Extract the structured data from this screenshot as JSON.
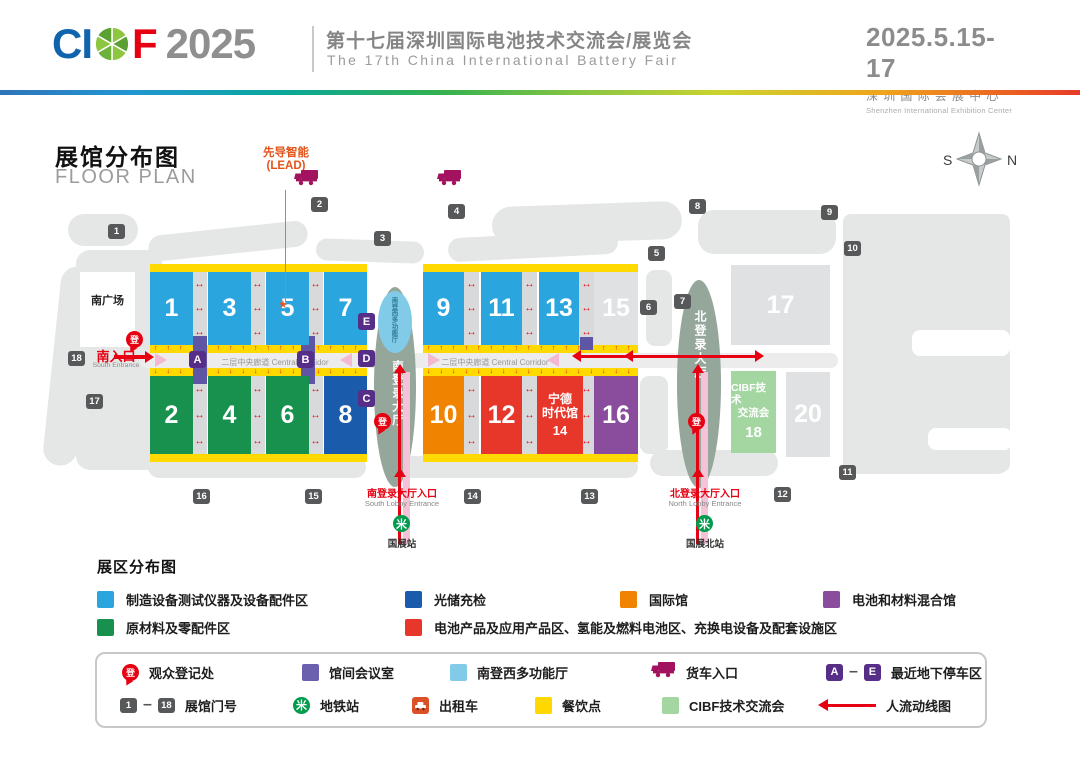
{
  "header": {
    "logo_ci": "CI",
    "logo_f": "F",
    "logo_year": "2025",
    "title_cn": "第十七届深圳国际电池技术交流会/展览会",
    "title_en": "The 17th China International Battery Fair",
    "dates": "2025.5.15-17",
    "venue_cn": "深圳国际会展中心",
    "venue_en": "Shenzhen International Exhibition Center"
  },
  "plan": {
    "title_cn": "展馆分布图",
    "title_en": "FLOOR PLAN",
    "lead_line1": "先导智能",
    "lead_line2": "(LEAD)",
    "compass_s": "S",
    "compass_n": "N",
    "south_plaza": "南广场",
    "south_entrance_cn": "南入口",
    "south_entrance_en": "South Entrance",
    "corridor_label": "二层中央廊道 Central Corridor",
    "south_lobby": "南登录大厅",
    "north_lobby": "北登录大厅",
    "multifunction_hall": "南登西多功能厅",
    "south_lobby_entrance_cn": "南登录大厅入口",
    "south_lobby_entrance_en": "South Lobby Entrance",
    "north_lobby_entrance_cn": "北登录大厅入口",
    "north_lobby_entrance_en": "North Lobby Entrance",
    "metro_station_south": "国展站",
    "metro_station_north": "国展北站",
    "halls": [
      {
        "n": "1",
        "x": 150,
        "y": 272,
        "w": 43,
        "h": 73,
        "c": "blue"
      },
      {
        "n": "3",
        "x": 208,
        "y": 272,
        "w": 43,
        "h": 73,
        "c": "blue"
      },
      {
        "n": "5",
        "x": 266,
        "y": 272,
        "w": 43,
        "h": 73,
        "c": "blue"
      },
      {
        "n": "7",
        "x": 324,
        "y": 272,
        "w": 43,
        "h": 73,
        "c": "blue"
      },
      {
        "n": "9",
        "x": 423,
        "y": 272,
        "w": 41,
        "h": 73,
        "c": "blue"
      },
      {
        "n": "11",
        "x": 481,
        "y": 272,
        "w": 41,
        "h": 73,
        "c": "blue"
      },
      {
        "n": "13",
        "x": 539,
        "y": 272,
        "w": 40,
        "h": 73,
        "c": "blue"
      },
      {
        "n": "15",
        "x": 594,
        "y": 272,
        "w": 44,
        "h": 73,
        "c": "gray"
      },
      {
        "n": "2",
        "x": 150,
        "y": 376,
        "w": 43,
        "h": 78,
        "c": "green"
      },
      {
        "n": "4",
        "x": 208,
        "y": 376,
        "w": 43,
        "h": 78,
        "c": "green"
      },
      {
        "n": "6",
        "x": 266,
        "y": 376,
        "w": 43,
        "h": 78,
        "c": "green"
      },
      {
        "n": "8",
        "x": 324,
        "y": 376,
        "w": 43,
        "h": 78,
        "c": "navy"
      },
      {
        "n": "10",
        "x": 423,
        "y": 376,
        "w": 41,
        "h": 78,
        "c": "orange"
      },
      {
        "n": "12",
        "x": 481,
        "y": 376,
        "w": 41,
        "h": 78,
        "c": "red"
      },
      {
        "n": "14",
        "lines": [
          "宁德",
          "时代馆"
        ],
        "x": 537,
        "y": 376,
        "w": 46,
        "h": 78,
        "c": "red"
      },
      {
        "n": "16",
        "x": 594,
        "y": 376,
        "w": 44,
        "h": 78,
        "c": "purple"
      },
      {
        "n": "17",
        "x": 731,
        "y": 265,
        "w": 99,
        "h": 80,
        "c": "gray"
      },
      {
        "n": "18",
        "lines": [
          "CIBF技术",
          "交流会"
        ],
        "x": 731,
        "y": 371,
        "w": 45,
        "h": 82,
        "c": "lightgreen"
      },
      {
        "n": "20",
        "x": 786,
        "y": 372,
        "w": 44,
        "h": 85,
        "c": "gray"
      }
    ],
    "gates": [
      {
        "n": "1",
        "x": 108,
        "y": 224
      },
      {
        "n": "2",
        "x": 311,
        "y": 197
      },
      {
        "n": "3",
        "x": 374,
        "y": 231
      },
      {
        "n": "4",
        "x": 448,
        "y": 204
      },
      {
        "n": "5",
        "x": 648,
        "y": 246
      },
      {
        "n": "6",
        "x": 640,
        "y": 300
      },
      {
        "n": "7",
        "x": 674,
        "y": 294
      },
      {
        "n": "8",
        "x": 689,
        "y": 199
      },
      {
        "n": "9",
        "x": 821,
        "y": 205
      },
      {
        "n": "10",
        "x": 844,
        "y": 241
      },
      {
        "n": "11",
        "x": 839,
        "y": 465
      },
      {
        "n": "12",
        "x": 774,
        "y": 487
      },
      {
        "n": "13",
        "x": 581,
        "y": 489
      },
      {
        "n": "14",
        "x": 464,
        "y": 489
      },
      {
        "n": "15",
        "x": 305,
        "y": 489
      },
      {
        "n": "16",
        "x": 193,
        "y": 489
      },
      {
        "n": "17",
        "x": 86,
        "y": 394
      },
      {
        "n": "18",
        "x": 68,
        "y": 351
      }
    ],
    "parking_badges": [
      {
        "n": "A",
        "x": 189,
        "y": 351
      },
      {
        "n": "B",
        "x": 297,
        "y": 351
      },
      {
        "n": "C",
        "x": 358,
        "y": 390
      },
      {
        "n": "D",
        "x": 358,
        "y": 350
      },
      {
        "n": "E",
        "x": 358,
        "y": 313
      }
    ],
    "registration_label": "登",
    "registration_pins": [
      {
        "x": 126,
        "y": 331
      },
      {
        "x": 374,
        "y": 413
      },
      {
        "x": 688,
        "y": 413
      }
    ],
    "truck_positions": [
      {
        "x": 293,
        "y": 169
      },
      {
        "x": 436,
        "y": 169
      }
    ]
  },
  "zones_legend": {
    "title": "展区分布图",
    "items": [
      {
        "color": "#2aa5dd",
        "label": "制造设备测试仪器及设备配件区",
        "x": 97,
        "y": 590
      },
      {
        "color": "#1a5cab",
        "label": "光储充检",
        "x": 405,
        "y": 590
      },
      {
        "color": "#f08300",
        "label": "国际馆",
        "x": 620,
        "y": 590
      },
      {
        "color": "#8a4d9e",
        "label": "电池和材料混合馆",
        "x": 823,
        "y": 590
      },
      {
        "color": "#17914d",
        "label": "原材料及零配件区",
        "x": 97,
        "y": 618
      },
      {
        "color": "#e7372a",
        "label": "电池产品及应用产品区、氢能及燃料电池区、充换电设备及配套设施区",
        "x": 405,
        "y": 618
      }
    ]
  },
  "icons_legend": {
    "items": [
      {
        "type": "pin",
        "label": "观众登记处",
        "x": 122,
        "y": 662
      },
      {
        "type": "square",
        "color": "#6a60ad",
        "label": "馆间会议室",
        "x": 302,
        "y": 662
      },
      {
        "type": "square",
        "color": "#82cbe8",
        "label": "南登西多功能厅",
        "x": 450,
        "y": 662
      },
      {
        "type": "truck",
        "label": "货车入口",
        "x": 650,
        "y": 662
      },
      {
        "type": "parking_range",
        "from": "A",
        "to": "E",
        "label": "最近地下停车区",
        "x": 826,
        "y": 662
      },
      {
        "type": "gate_range",
        "from": "1",
        "to": "18",
        "label": "展馆门号",
        "x": 120,
        "y": 695
      },
      {
        "type": "metro",
        "label": "地铁站",
        "x": 293,
        "y": 695
      },
      {
        "type": "taxi",
        "label": "出租车",
        "x": 412,
        "y": 695
      },
      {
        "type": "square",
        "color": "#ffd800",
        "label": "餐饮点",
        "x": 535,
        "y": 695
      },
      {
        "type": "square",
        "color": "#a4d6a2",
        "label": "CIBF技术交流会",
        "x": 662,
        "y": 695
      },
      {
        "type": "flow_arrow",
        "label": "人流动线图",
        "x": 818,
        "y": 695
      }
    ]
  }
}
